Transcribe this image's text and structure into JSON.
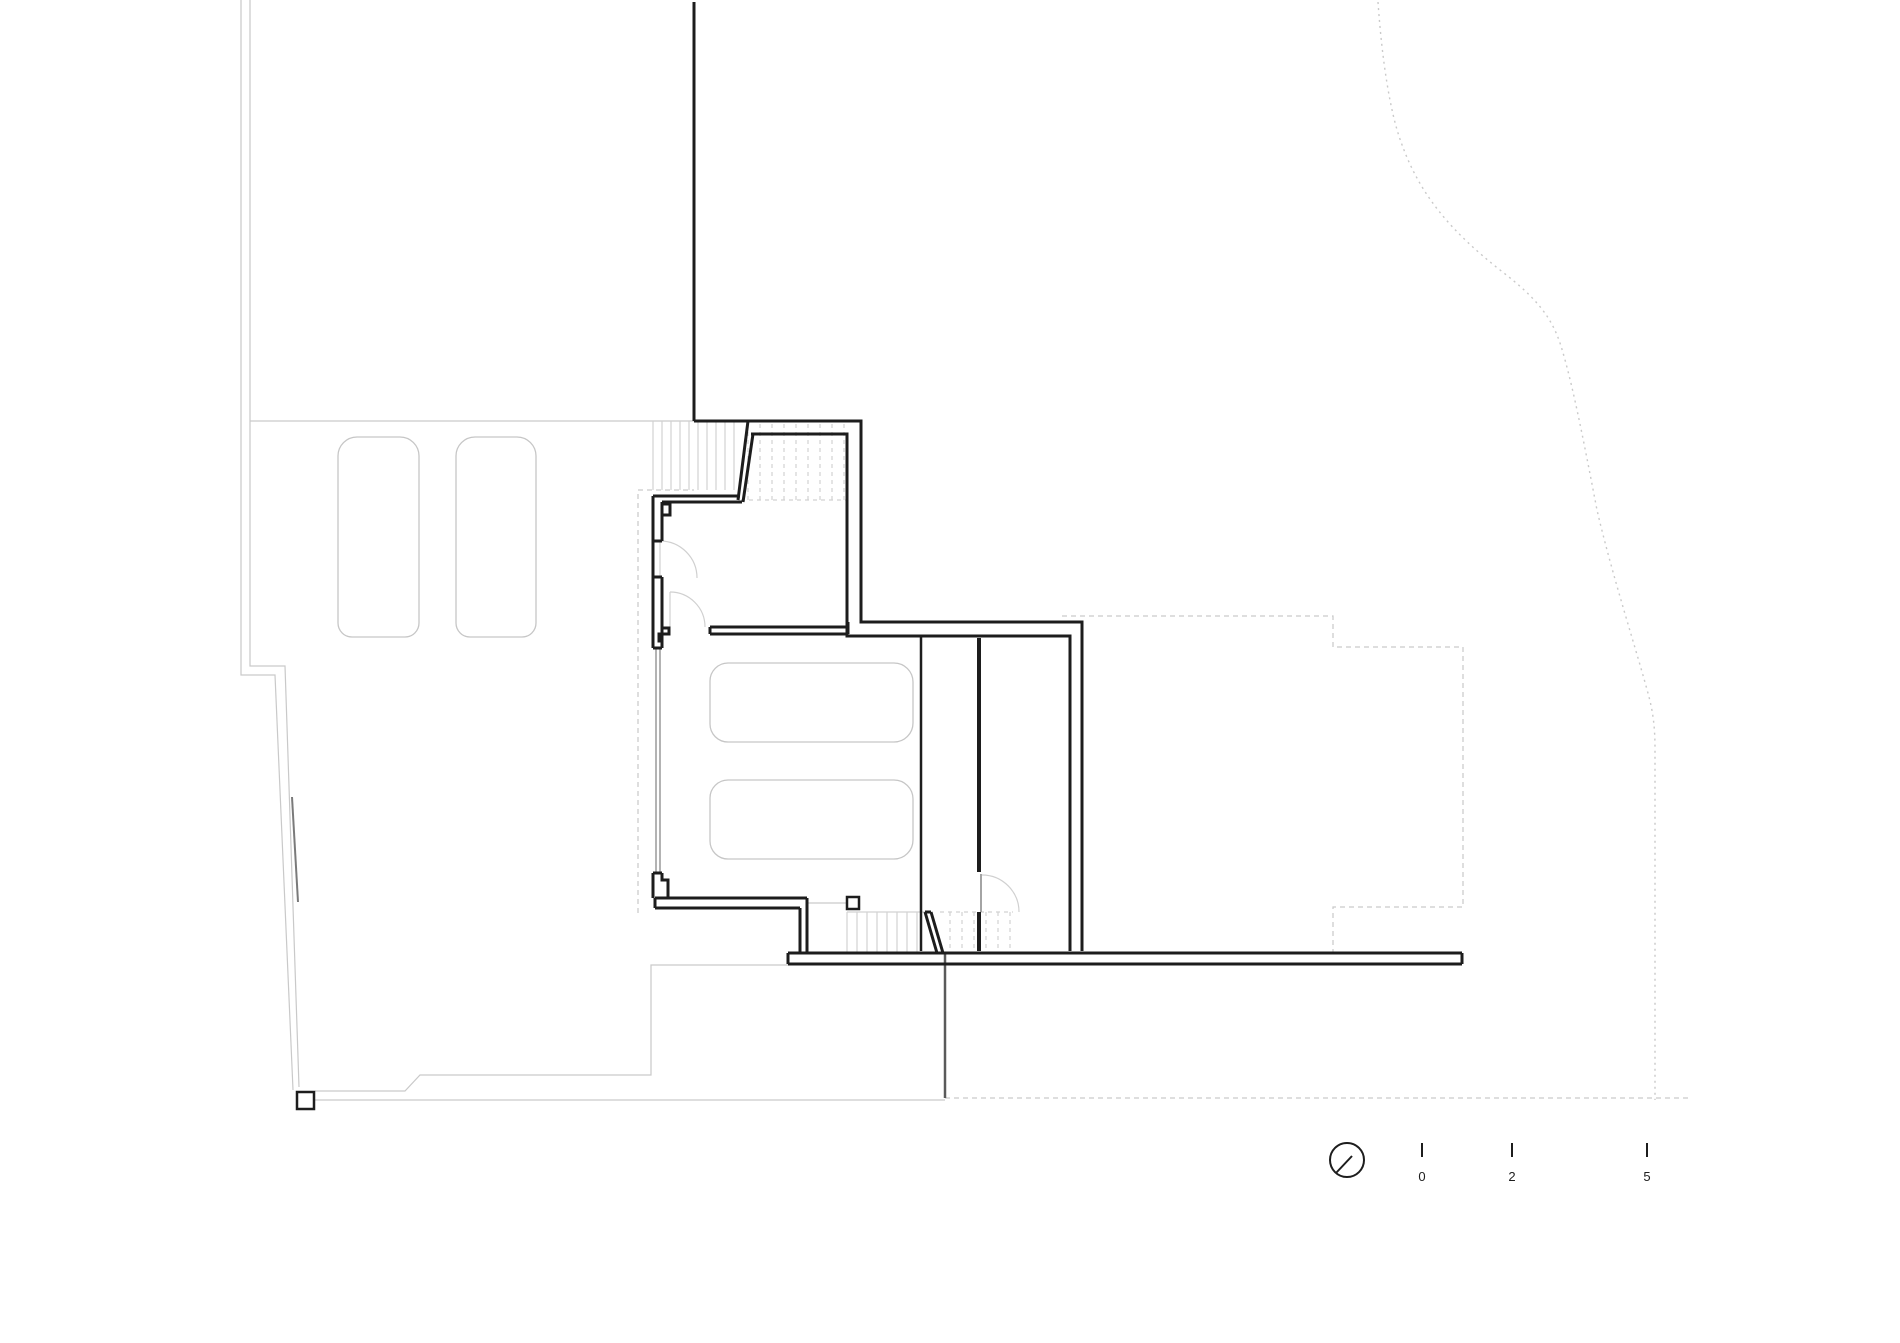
{
  "meta": {
    "kind": "architectural site / floor plan drawing",
    "background": "#ffffff",
    "ink": "#1d1d1d",
    "light_line": "#c9c9c9",
    "mid_line": "#8a8a8a"
  },
  "scale_bar": {
    "ticks": [
      {
        "label": "0",
        "x": 1422,
        "y": 1181
      },
      {
        "label": "2",
        "x": 1512,
        "y": 1181
      },
      {
        "label": "5",
        "x": 1647,
        "y": 1181
      }
    ]
  },
  "symbols": {
    "north_marker": "circle with needle slash",
    "stairs": "parallel tread lines, dashed where above cut plane",
    "doors": "quarter-circle swing arcs",
    "cars": "rounded outline vehicles, 2 in parking lot, 2 in garage"
  },
  "drawing": {
    "width": 1900,
    "height": 1343,
    "layers": [
      {
        "name": "site-boundary-left",
        "stroke": "#c9c9c9",
        "width": 1.2,
        "paths": [
          "M241,0 V675 H275 L293,1090",
          "M250,0 V666 H285 L299,1087",
          "M250,421 H694"
        ]
      },
      {
        "name": "site-boundary-dark-overlay",
        "stroke": "#7a7a7a",
        "width": 2,
        "paths": [
          "M292,797 L298,902"
        ]
      },
      {
        "name": "courtyard-lines",
        "stroke": "#c9c9c9",
        "width": 1.2,
        "paths": [
          "M315,1091 H405 L420,1075 H651 V965 H788",
          "M315,1100 H945",
          "M807,903 H847"
        ]
      },
      {
        "name": "site-boundary-dotted-east",
        "stroke": "#c9c9c9",
        "width": 1.4,
        "dash": "2,4",
        "paths": [
          "M1378,2 C1382,60 1390,112 1401,142 C1420,196 1452,232 1500,270 C1538,299 1552,318 1561,346 C1572,382 1582,432 1597,510 C1612,575 1638,655 1649,697 C1653,712 1655,728 1655,748 V1100"
        ]
      },
      {
        "name": "site-boundary-dashed-bottom",
        "stroke": "#c9c9c9",
        "width": 1.2,
        "dash": "5,4",
        "paths": [
          "M945,1098 H1692"
        ]
      },
      {
        "name": "upper-floor-outline-dashed",
        "stroke": "#c9c9c9",
        "width": 1.2,
        "dash": "5,4",
        "paths": [
          "M638,913 V490 H694",
          "M1062,616 H1333 V647 H1463 V907 H1333 V953"
        ]
      },
      {
        "name": "parking-car",
        "stroke": "#c6c6c6",
        "width": 1.3,
        "paths": [
          "M338,456 a19,19 0 0 1 19,-19 h43 a19,19 0 0 1 19,19 v167 a14,14 0 0 1 -14,14 h-53 a14,14 0 0 1 -14,-14 z",
          "M456,456 a19,19 0 0 1 19,-19 h42 a19,19 0 0 1 19,19 v167 a14,14 0 0 1 -14,14 h-52 a14,14 0 0 1 -14,-14 z"
        ]
      },
      {
        "name": "garage-car",
        "stroke": "#c6c6c6",
        "width": 1.3,
        "paths": [
          "M728,663 h166 a19,19 0 0 1 19,19 v41 a19,19 0 0 1 -19,19 h-166 a18,18 0 0 1 -18,-18 v-43 a18,18 0 0 1 18,-18 z",
          "M728,780 h166 a19,19 0 0 1 19,19 v41 a19,19 0 0 1 -19,19 h-166 a18,18 0 0 1 -18,-18 v-43 a18,18 0 0 1 18,-18 z"
        ]
      },
      {
        "name": "stair-treads-entry",
        "stroke": "#d2d2d2",
        "width": 1.2,
        "paths": [
          "M653,421 V490 M662,421 V490 M671,421 V490 M680,421 V490 M689,421 V490 M698,421 V490 M707,421 V490 M716,421 V490 M725,421 V490 M734,421 V490"
        ]
      },
      {
        "name": "stair-treads-entry-dashed",
        "stroke": "#d2d2d2",
        "width": 1.2,
        "dash": "4,4",
        "paths": [
          "M748,424 V500 M760,424 V500 M772,424 V500 M784,424 V500 M796,424 V500 M808,424 V500 M820,424 V500 M832,424 V500 M844,424 V500",
          "M741,500 H847"
        ]
      },
      {
        "name": "stair-treads-lower",
        "stroke": "#d2d2d2",
        "width": 1.2,
        "paths": [
          "M847,912 V952 M857,912 V952 M867,912 V952 M877,912 V952 M887,912 V952 M897,912 V952 M907,912 V952 M917,912 V952",
          "M847,912 H927"
        ]
      },
      {
        "name": "stair-treads-lower-dashed",
        "stroke": "#d2d2d2",
        "width": 1.2,
        "dash": "4,4",
        "paths": [
          "M950,912 V951 M962,912 V951 M974,912 V951 M986,912 V951 M998,912 V951 M1010,912 V951",
          "M940,912 H1013"
        ]
      },
      {
        "name": "door-swing-arc",
        "stroke": "#d0d0d0",
        "width": 1.2,
        "paths": [
          "M660,541 V577",
          "M660,541 A37,37 0 0 1 697,578",
          "M670,592 V627",
          "M670,592 A35,35 0 0 1 705,627",
          "M982,875 A37,37 0 0 1 1019,912"
        ]
      },
      {
        "name": "door-leaf-east",
        "stroke": "#9a9a9a",
        "width": 1.8,
        "paths": [
          "M981,874 V912"
        ]
      },
      {
        "name": "garage-door-west",
        "stroke": "#9a9a9a",
        "width": 1.5,
        "paths": [
          "M656,648 V873",
          "M660,648 V873"
        ]
      },
      {
        "name": "section-line",
        "stroke": "#5a5a5a",
        "width": 2.5,
        "paths": [
          "M945,953 V1098"
        ]
      },
      {
        "name": "wall",
        "stroke": "#1d1d1d",
        "width": 3,
        "paths": [
          "M694,2 V421",
          "M694,421 H861 V622 H1082 V951",
          "M751,434 H847 V622",
          "M847,622 V636 H861",
          "M861,636 H1070 V951",
          "M748,421 L738,500",
          "M753,434 L743,502",
          "M653,496 H740",
          "M662,502 H742",
          "M653,496 V648",
          "M662,502 V541 M662,577 V648 M653,541 H662 M653,577 H662 M653,648 H662",
          "M662,504 H670 V515 H662",
          "M662,628 H669 V634 H659 V641 H662",
          "M710,627 H848 M710,634 H848 M710,627 V634 M848,622 V634",
          "M655,898 H807 M655,908 H800 M655,898 V908",
          "M653,873 V898 M653,873 H662 M662,873 V880 H668 V898",
          "M800,908 V953 M807,898 V953",
          "M788,953 H1462 M788,964 H1462 M788,953 V964 M1462,953 V964",
          "M925,912 L937,953 M931,912 L943,953 M925,912 H931"
        ]
      },
      {
        "name": "wall-thin",
        "stroke": "#1d1d1d",
        "width": 2.5,
        "paths": [
          "M921,636 V951"
        ]
      },
      {
        "name": "wall-stair-room",
        "stroke": "#1d1d1d",
        "width": 4,
        "paths": [
          "M979,638 V872",
          "M979,912 V951"
        ]
      },
      {
        "name": "column-square",
        "stroke": "#1d1d1d",
        "width": 2.5,
        "fill": "#ffffff",
        "paths": [
          "M847,897 h12 v12 h-12 Z",
          "M297,1092 h17 v17 h-17 Z"
        ]
      },
      {
        "name": "north-marker-icon",
        "stroke": "#1d1d1d",
        "width": 2,
        "paths": [
          "M1364,1160 a17,17 0 1 1 -34,0 a17,17 0 1 1 34,0",
          "M1336,1173 L1352,1156"
        ]
      },
      {
        "name": "scale-bar-ticks",
        "stroke": "#1d1d1d",
        "width": 2,
        "paths": [
          "M1422,1143 V1157",
          "M1512,1143 V1157",
          "M1647,1143 V1157"
        ]
      }
    ]
  }
}
